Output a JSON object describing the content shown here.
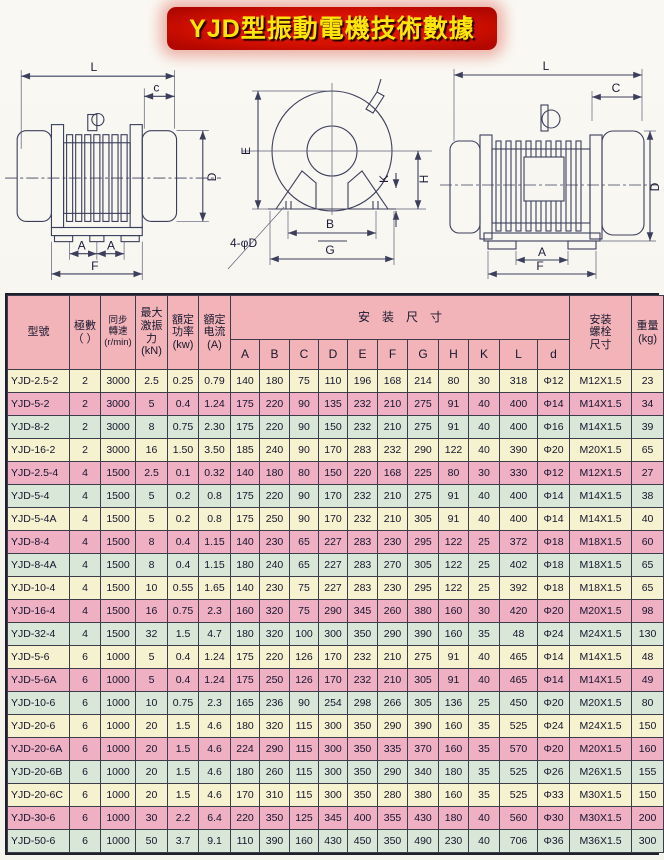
{
  "title": "YJD型振動電機技術數據",
  "drawings": {
    "left": {
      "L": "L",
      "c": "c",
      "D": "D",
      "A1": "A",
      "A2": "A",
      "F": "F"
    },
    "middle": {
      "E": "E",
      "K": "K",
      "H": "H",
      "B": "B",
      "G": "G",
      "holes": "4-φD"
    },
    "right": {
      "L": "L",
      "C": "C",
      "D": "D",
      "A": "A",
      "F": "F"
    }
  },
  "table": {
    "headers": {
      "model": "型號",
      "poles": "極數\n（ ）",
      "speed": "同步\n轉速\n(r/min)",
      "force": "最大\n激振\n力\n(kN)",
      "power": "額定\n功率\n(kw)",
      "current": "額定\n电流\n(A)",
      "install": "安装尺寸",
      "dims": [
        "A",
        "B",
        "C",
        "D",
        "E",
        "F",
        "G",
        "H",
        "K",
        "L",
        "d"
      ],
      "bolt": "安装\n螺栓\n尺寸",
      "weight": "重量\n(kg)"
    },
    "rows": [
      {
        "model": "YJD-2.5-2",
        "poles": "2",
        "speed": "3000",
        "force": "2.5",
        "power": "0.25",
        "current": "0.79",
        "dims": [
          "140",
          "180",
          "75",
          "110",
          "196",
          "168",
          "214",
          "80",
          "30",
          "318",
          "Φ12"
        ],
        "bolt": "M12X1.5",
        "weight": "23"
      },
      {
        "model": "YJD-5-2",
        "poles": "2",
        "speed": "3000",
        "force": "5",
        "power": "0.4",
        "current": "1.24",
        "dims": [
          "175",
          "220",
          "90",
          "135",
          "232",
          "210",
          "275",
          "91",
          "40",
          "400",
          "Φ14"
        ],
        "bolt": "M14X1.5",
        "weight": "34"
      },
      {
        "model": "YJD-8-2",
        "poles": "2",
        "speed": "3000",
        "force": "8",
        "power": "0.75",
        "current": "2.30",
        "dims": [
          "175",
          "220",
          "90",
          "150",
          "232",
          "210",
          "275",
          "91",
          "40",
          "400",
          "Φ16"
        ],
        "bolt": "M14X1.5",
        "weight": "39"
      },
      {
        "model": "YJD-16-2",
        "poles": "2",
        "speed": "3000",
        "force": "16",
        "power": "1.50",
        "current": "3.50",
        "dims": [
          "185",
          "240",
          "90",
          "170",
          "283",
          "232",
          "290",
          "122",
          "40",
          "390",
          "Φ20"
        ],
        "bolt": "M20X1.5",
        "weight": "65"
      },
      {
        "model": "YJD-2.5-4",
        "poles": "4",
        "speed": "1500",
        "force": "2.5",
        "power": "0.1",
        "current": "0.32",
        "dims": [
          "140",
          "180",
          "80",
          "150",
          "220",
          "168",
          "225",
          "80",
          "30",
          "330",
          "Φ12"
        ],
        "bolt": "M12X1.5",
        "weight": "27"
      },
      {
        "model": "YJD-5-4",
        "poles": "4",
        "speed": "1500",
        "force": "5",
        "power": "0.2",
        "current": "0.8",
        "dims": [
          "175",
          "220",
          "90",
          "170",
          "232",
          "210",
          "275",
          "91",
          "40",
          "400",
          "Φ14"
        ],
        "bolt": "M14X1.5",
        "weight": "38"
      },
      {
        "model": "YJD-5-4A",
        "poles": "4",
        "speed": "1500",
        "force": "5",
        "power": "0.2",
        "current": "0.8",
        "dims": [
          "175",
          "250",
          "90",
          "170",
          "232",
          "210",
          "305",
          "91",
          "40",
          "400",
          "Φ14"
        ],
        "bolt": "M14X1.5",
        "weight": "40"
      },
      {
        "model": "YJD-8-4",
        "poles": "4",
        "speed": "1500",
        "force": "8",
        "power": "0.4",
        "current": "1.15",
        "dims": [
          "140",
          "230",
          "65",
          "227",
          "283",
          "230",
          "295",
          "122",
          "25",
          "372",
          "Φ18"
        ],
        "bolt": "M18X1.5",
        "weight": "60"
      },
      {
        "model": "YJD-8-4A",
        "poles": "4",
        "speed": "1500",
        "force": "8",
        "power": "0.4",
        "current": "1.15",
        "dims": [
          "180",
          "240",
          "65",
          "227",
          "283",
          "270",
          "305",
          "122",
          "25",
          "402",
          "Φ18"
        ],
        "bolt": "M18X1.5",
        "weight": "65"
      },
      {
        "model": "YJD-10-4",
        "poles": "4",
        "speed": "1500",
        "force": "10",
        "power": "0.55",
        "current": "1.65",
        "dims": [
          "140",
          "230",
          "75",
          "227",
          "283",
          "230",
          "295",
          "122",
          "25",
          "392",
          "Φ18"
        ],
        "bolt": "M18X1.5",
        "weight": "65"
      },
      {
        "model": "YJD-16-4",
        "poles": "4",
        "speed": "1500",
        "force": "16",
        "power": "0.75",
        "current": "2.3",
        "dims": [
          "160",
          "320",
          "75",
          "290",
          "345",
          "260",
          "380",
          "160",
          "30",
          "420",
          "Φ20"
        ],
        "bolt": "M20X1.5",
        "weight": "98"
      },
      {
        "model": "YJD-32-4",
        "poles": "4",
        "speed": "1500",
        "force": "32",
        "power": "1.5",
        "current": "4.7",
        "dims": [
          "180",
          "320",
          "100",
          "300",
          "350",
          "290",
          "390",
          "160",
          "35",
          "48",
          "Φ24"
        ],
        "bolt": "M24X1.5",
        "weight": "130"
      },
      {
        "model": "YJD-5-6",
        "poles": "6",
        "speed": "1000",
        "force": "5",
        "power": "0.4",
        "current": "1.24",
        "dims": [
          "175",
          "220",
          "126",
          "170",
          "232",
          "210",
          "275",
          "91",
          "40",
          "465",
          "Φ14"
        ],
        "bolt": "M14X1.5",
        "weight": "48"
      },
      {
        "model": "YJD-5-6A",
        "poles": "6",
        "speed": "1000",
        "force": "5",
        "power": "0.4",
        "current": "1.24",
        "dims": [
          "175",
          "250",
          "126",
          "170",
          "232",
          "210",
          "305",
          "91",
          "40",
          "465",
          "Φ14"
        ],
        "bolt": "M14X1.5",
        "weight": "49"
      },
      {
        "model": "YJD-10-6",
        "poles": "6",
        "speed": "1000",
        "force": "10",
        "power": "0.75",
        "current": "2.3",
        "dims": [
          "165",
          "236",
          "90",
          "254",
          "298",
          "266",
          "305",
          "136",
          "25",
          "450",
          "Φ20"
        ],
        "bolt": "M20X1.5",
        "weight": "80"
      },
      {
        "model": "YJD-20-6",
        "poles": "6",
        "speed": "1000",
        "force": "20",
        "power": "1.5",
        "current": "4.6",
        "dims": [
          "180",
          "320",
          "115",
          "300",
          "350",
          "290",
          "390",
          "160",
          "35",
          "525",
          "Φ24"
        ],
        "bolt": "M24X1.5",
        "weight": "150"
      },
      {
        "model": "YJD-20-6A",
        "poles": "6",
        "speed": "1000",
        "force": "20",
        "power": "1.5",
        "current": "4.6",
        "dims": [
          "224",
          "290",
          "115",
          "300",
          "350",
          "335",
          "370",
          "160",
          "35",
          "570",
          "Φ20"
        ],
        "bolt": "M20X1.5",
        "weight": "160"
      },
      {
        "model": "YJD-20-6B",
        "poles": "6",
        "speed": "1000",
        "force": "20",
        "power": "1.5",
        "current": "4.6",
        "dims": [
          "180",
          "260",
          "115",
          "300",
          "350",
          "290",
          "340",
          "180",
          "35",
          "525",
          "Φ26"
        ],
        "bolt": "M26X1.5",
        "weight": "155"
      },
      {
        "model": "YJD-20-6C",
        "poles": "6",
        "speed": "1000",
        "force": "20",
        "power": "1.5",
        "current": "4.6",
        "dims": [
          "170",
          "310",
          "115",
          "300",
          "350",
          "280",
          "380",
          "160",
          "35",
          "525",
          "Φ33"
        ],
        "bolt": "M30X1.5",
        "weight": "150"
      },
      {
        "model": "YJD-30-6",
        "poles": "6",
        "speed": "1000",
        "force": "30",
        "power": "2.2",
        "current": "6.4",
        "dims": [
          "220",
          "350",
          "125",
          "345",
          "400",
          "355",
          "430",
          "180",
          "40",
          "560",
          "Φ30"
        ],
        "bolt": "M30X1.5",
        "weight": "200"
      },
      {
        "model": "YJD-50-6",
        "poles": "6",
        "speed": "1000",
        "force": "50",
        "power": "3.7",
        "current": "9.1",
        "dims": [
          "110",
          "390",
          "160",
          "430",
          "450",
          "350",
          "490",
          "230",
          "40",
          "706",
          "Φ36"
        ],
        "bolt": "M36X1.5",
        "weight": "300"
      }
    ]
  }
}
